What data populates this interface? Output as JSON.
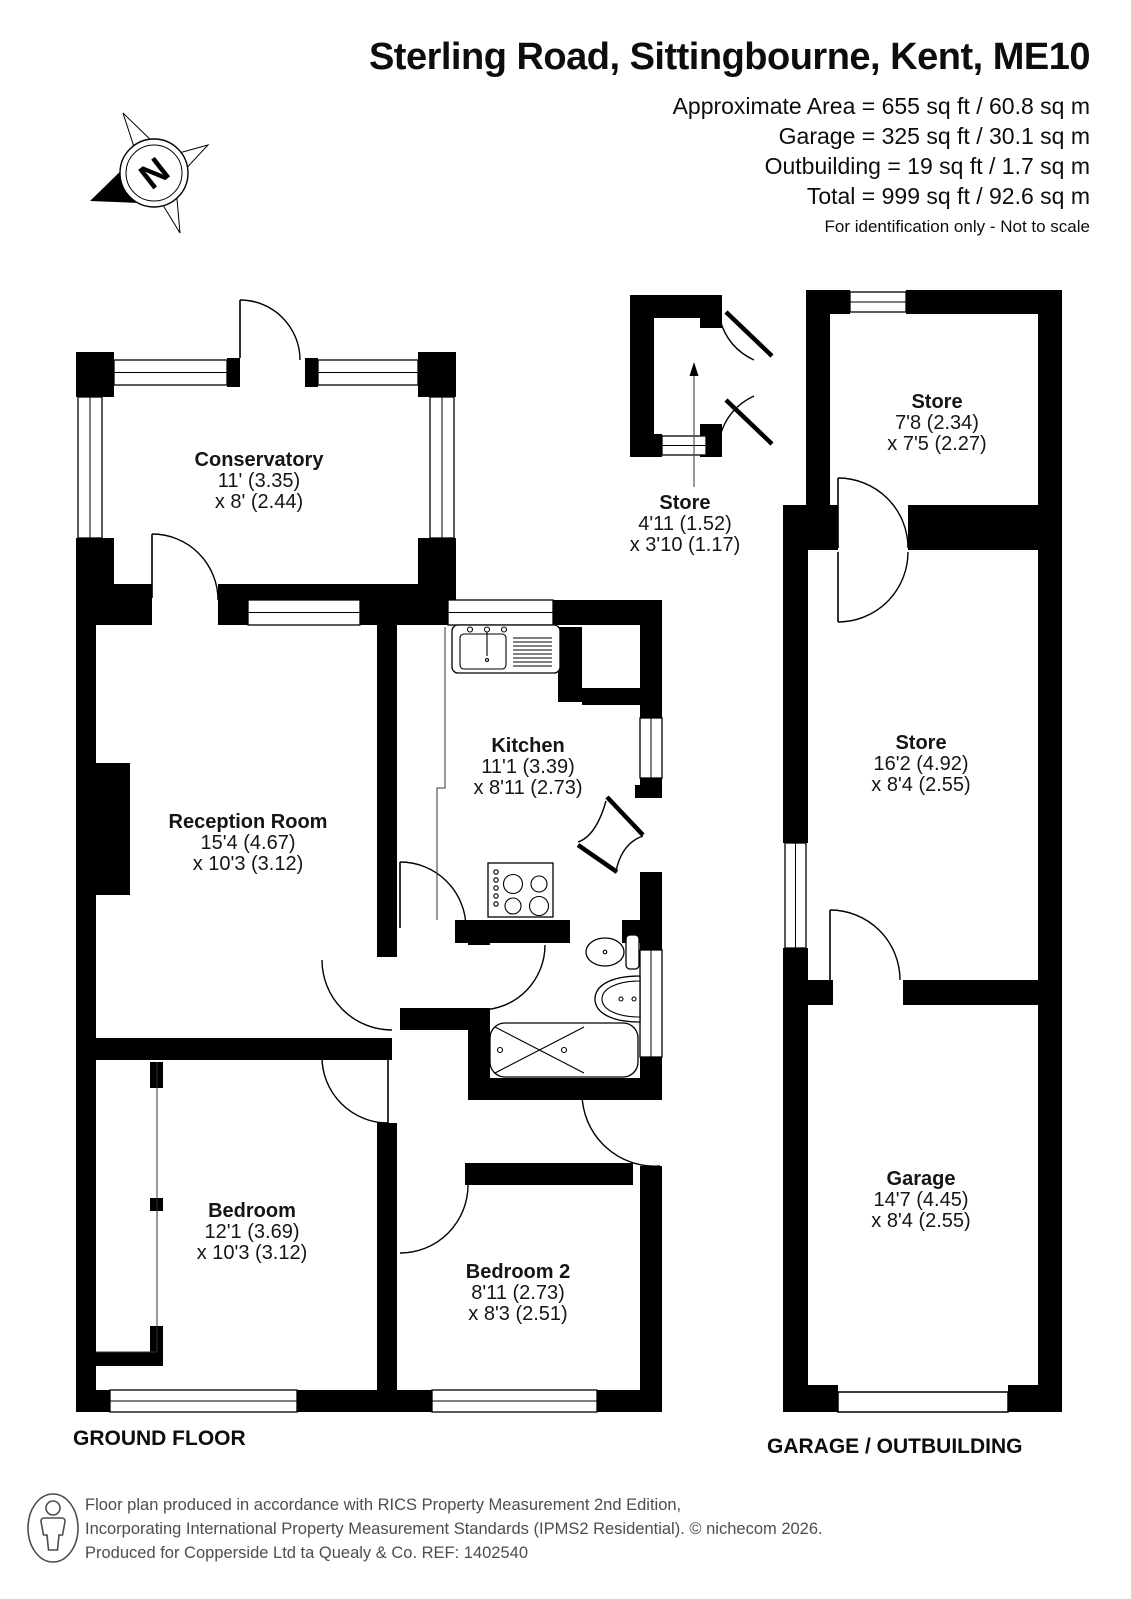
{
  "header": {
    "title": "Sterling Road, Sittingbourne, Kent, ME10",
    "area_lines": [
      "Approximate Area = 655 sq ft / 60.8 sq m",
      "Garage = 325 sq ft / 30.1 sq m",
      "Outbuilding = 19 sq ft / 1.7 sq m",
      "Total = 999 sq ft / 92.6 sq m"
    ],
    "note": "For identification only - Not to scale"
  },
  "compass": {
    "label": "N"
  },
  "rooms": [
    {
      "id": "conservatory",
      "name": "Conservatory",
      "dim1": "11' (3.35)",
      "dim2": "x 8' (2.44)"
    },
    {
      "id": "reception",
      "name": "Reception Room",
      "dim1": "15'4 (4.67)",
      "dim2": "x 10'3 (3.12)"
    },
    {
      "id": "kitchen",
      "name": "Kitchen",
      "dim1": "11'1 (3.39)",
      "dim2": "x 8'11 (2.73)"
    },
    {
      "id": "bedroom",
      "name": "Bedroom",
      "dim1": "12'1 (3.69)",
      "dim2": "x 10'3 (3.12)"
    },
    {
      "id": "bedroom2",
      "name": "Bedroom 2",
      "dim1": "8'11 (2.73)",
      "dim2": "x 8'3 (2.51)"
    },
    {
      "id": "store-small",
      "name": "Store",
      "dim1": "4'11 (1.52)",
      "dim2": "x 3'10 (1.17)"
    },
    {
      "id": "store-top",
      "name": "Store",
      "dim1": "7'8 (2.34)",
      "dim2": "x 7'5 (2.27)"
    },
    {
      "id": "store-long",
      "name": "Store",
      "dim1": "16'2 (4.92)",
      "dim2": "x 8'4 (2.55)"
    },
    {
      "id": "garage",
      "name": "Garage",
      "dim1": "14'7 (4.45)",
      "dim2": "x 8'4 (2.55)"
    }
  ],
  "floor_labels": {
    "ground": "GROUND FLOOR",
    "outbuilding": "GARAGE / OUTBUILDING"
  },
  "footer": {
    "line1": "Floor plan produced in accordance with RICS Property Measurement 2nd Edition,",
    "line2": "Incorporating International Property Measurement Standards (IPMS2 Residential).   © nichecom 2026.",
    "line3": "Produced for Copperside Ltd ta Quealy & Co.   REF: 1402540"
  }
}
